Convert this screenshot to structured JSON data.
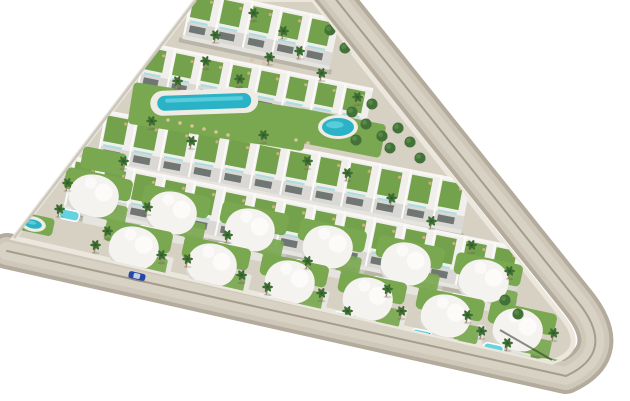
{
  "image": {
    "type": "architectural-aerial-render",
    "description": "Aerial 3D rendering of a triangular residential development with terraced apartment blocks with green roof gardens, a communal lap pool and round pool, rows of curved white villas with private turquoise pools, palm trees, perimeter roads and a blue car driving on the lower road",
    "width": 630,
    "height": 401,
    "background": "#ffffff"
  },
  "palette": {
    "bg": "#ffffff",
    "road": "#cfc8ba",
    "roadShoulder": "#b3ab9b",
    "roadInner": "#d8d2c5",
    "roadLine": "#a59c8b",
    "sidewalk": "#ebe7dc",
    "ground": "#d7d1c4",
    "concrete": "#e6e4df",
    "buildingTop": "#f0efec",
    "buildingFace": "#d9d8d4",
    "window": "#5d6563",
    "rail": "#7fd4da",
    "roofLawn": "#74a14b",
    "lawn": "#7aa850",
    "poolDeep": "#2ab3c6",
    "poolLight": "#64d2df",
    "palm": "#3e6e33",
    "palmTrunk": "#9b8a68",
    "tree": "#44703a",
    "wall": "#cbc7bf",
    "shadow": "rgba(55,55,50,0.18)",
    "deck": "#efece5",
    "car": "#2448a8"
  },
  "roads": {
    "centerline": "M330,-8 L578,302 Q618,352 566,376 L7,251",
    "layers": [
      {
        "width": 36,
        "class": "road-shoulder"
      },
      {
        "width": 28,
        "class": "road-main"
      },
      {
        "width": 18,
        "class": "road-inner"
      },
      {
        "width": 2,
        "class": "road-line"
      }
    ]
  },
  "site": {
    "outline": "M196,0 L311,0 L563,318 Q588,350 552,362 L14,238 Z",
    "left_wall": "M196,0 L14,238",
    "corner_curb": "M500,330 L552,360"
  },
  "apex_ground": "244,2 312,2 352,54 264,46",
  "apartment_rows": [
    {
      "x": 193,
      "y": -12,
      "len": 150,
      "depth": 48,
      "angle": 12,
      "units": 5
    },
    {
      "x": 146,
      "y": 42,
      "len": 232,
      "depth": 46,
      "angle": 11.5,
      "units": 8
    },
    {
      "x": 106,
      "y": 110,
      "len": 372,
      "depth": 50,
      "angle": 11,
      "units": 12
    },
    {
      "x": 74,
      "y": 156,
      "len": 460,
      "depth": 50,
      "angle": 11.5,
      "units": 15
    }
  ],
  "gardens": [
    {
      "x": 134,
      "y": 82,
      "w": 178,
      "h": 42,
      "angle": 9
    },
    {
      "x": 300,
      "y": 108,
      "w": 88,
      "h": 34,
      "angle": 11
    },
    {
      "x": 84,
      "y": 146,
      "w": 44,
      "h": 22,
      "angle": 11
    },
    {
      "x": 518,
      "y": 350,
      "w": 60,
      "h": 26,
      "angle": 14
    },
    {
      "x": 22,
      "y": 212,
      "w": 34,
      "h": 18,
      "angle": 12
    }
  ],
  "pools": [
    {
      "type": "lap",
      "x": 157,
      "y": 96,
      "w": 94,
      "h": 15,
      "angle": -2
    },
    {
      "type": "round",
      "cx": 338,
      "cy": 127,
      "rx": 16,
      "ry": 9,
      "angle": 0
    },
    {
      "type": "round",
      "cx": 547,
      "cy": 369,
      "rx": 15,
      "ry": 7,
      "angle": 14
    },
    {
      "type": "round",
      "cx": 33,
      "cy": 224,
      "rx": 9,
      "ry": 4.5,
      "angle": 12
    }
  ],
  "loungers": [
    [
      168,
      120
    ],
    [
      180,
      123
    ],
    [
      192,
      126
    ],
    [
      204,
      129
    ],
    [
      216,
      132
    ],
    [
      228,
      135
    ],
    [
      296,
      140
    ],
    [
      308,
      143
    ],
    [
      252,
      60
    ],
    [
      264,
      63
    ]
  ],
  "walkways": {
    "angle": 104,
    "width": 8,
    "items": [
      {
        "x": 134,
        "y": 206,
        "len": 54
      },
      {
        "x": 212,
        "y": 223,
        "len": 54
      },
      {
        "x": 290,
        "y": 240,
        "len": 54
      },
      {
        "x": 368,
        "y": 257,
        "len": 54
      },
      {
        "x": 446,
        "y": 274,
        "len": 54
      },
      {
        "x": 174,
        "y": 258,
        "len": 42
      },
      {
        "x": 252,
        "y": 275,
        "len": 42
      },
      {
        "x": 330,
        "y": 292,
        "len": 42
      },
      {
        "x": 408,
        "y": 309,
        "len": 42
      },
      {
        "x": 486,
        "y": 326,
        "len": 42
      }
    ]
  },
  "villas": {
    "angle": 12,
    "positions": [
      [
        95,
        200
      ],
      [
        173,
        217
      ],
      [
        251,
        234
      ],
      [
        329,
        251
      ],
      [
        407,
        268
      ],
      [
        485,
        285
      ],
      [
        135,
        252
      ],
      [
        213,
        269
      ],
      [
        291,
        286
      ],
      [
        369,
        303
      ],
      [
        447,
        320
      ],
      [
        519,
        334
      ]
    ]
  },
  "palms": [
    [
      214,
      42
    ],
    [
      252,
      20
    ],
    [
      282,
      38
    ],
    [
      298,
      58
    ],
    [
      268,
      64
    ],
    [
      320,
      80
    ],
    [
      356,
      104
    ],
    [
      238,
      86
    ],
    [
      204,
      68
    ],
    [
      176,
      88
    ],
    [
      150,
      128
    ],
    [
      190,
      148
    ],
    [
      262,
      142
    ],
    [
      306,
      168
    ],
    [
      346,
      180
    ],
    [
      390,
      205
    ],
    [
      430,
      228
    ],
    [
      470,
      252
    ],
    [
      508,
      278
    ],
    [
      122,
      168
    ],
    [
      66,
      190
    ],
    [
      106,
      238
    ],
    [
      146,
      214
    ],
    [
      186,
      266
    ],
    [
      226,
      242
    ],
    [
      266,
      294
    ],
    [
      306,
      268
    ],
    [
      346,
      318
    ],
    [
      386,
      296
    ],
    [
      426,
      345
    ],
    [
      466,
      322
    ],
    [
      506,
      350
    ],
    [
      58,
      216
    ],
    [
      94,
      252
    ],
    [
      160,
      262
    ],
    [
      240,
      282
    ],
    [
      320,
      300
    ],
    [
      400,
      318
    ],
    [
      480,
      338
    ],
    [
      552,
      340
    ]
  ],
  "trees": [
    [
      352,
      112
    ],
    [
      366,
      124
    ],
    [
      382,
      136
    ],
    [
      398,
      128
    ],
    [
      390,
      148
    ],
    [
      410,
      142
    ],
    [
      372,
      104
    ],
    [
      420,
      158
    ],
    [
      356,
      140
    ],
    [
      330,
      30
    ],
    [
      345,
      48
    ],
    [
      505,
      300
    ],
    [
      518,
      314
    ],
    [
      420,
      95
    ]
  ],
  "cars": [
    {
      "x": 137,
      "y": 276,
      "angle": 13,
      "color": "#2448a8"
    }
  ]
}
